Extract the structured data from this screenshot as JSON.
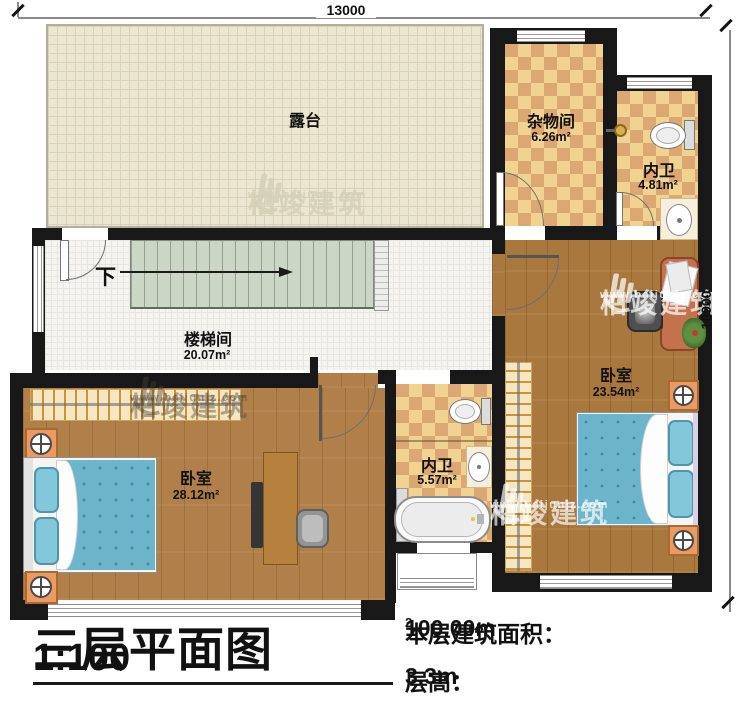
{
  "annotation": {
    "title": "三层平面图",
    "scale": "1:100",
    "area_label": "本层建筑面积：",
    "area_value": "100.00m",
    "area_superscript": "2",
    "height_label": "层高：",
    "height_value": "3.3m"
  },
  "dimensions": {
    "top": "13000",
    "right": "10900"
  },
  "rooms": {
    "terrace": {
      "name": "露台"
    },
    "storage": {
      "name": "杂物间",
      "area": "6.26m²"
    },
    "bath_upper": {
      "name": "内卫",
      "area": "4.81m²"
    },
    "stair_hall": {
      "name": "楼梯间",
      "area": "20.07m²"
    },
    "bath_middle": {
      "name": "内卫",
      "area": "5.57m²"
    },
    "bedroom_left": {
      "name": "卧室",
      "area": "28.12m²"
    },
    "bedroom_right": {
      "name": "卧室",
      "area": "23.54m²"
    }
  },
  "stairs": {
    "direction_label": "下"
  },
  "watermark": {
    "brand": "柏竣建筑",
    "website": "www.baijunjz.com"
  },
  "colors": {
    "wall": "#181818",
    "checker_light": "#f1d291",
    "checker_dark": "#dba873",
    "wood": "#ad7c44",
    "terrace": "#eae6d0",
    "stair_tread": "#ccd6c7",
    "bed_blue": "#6db5cb",
    "furniture_orange": "#eb9b61"
  }
}
